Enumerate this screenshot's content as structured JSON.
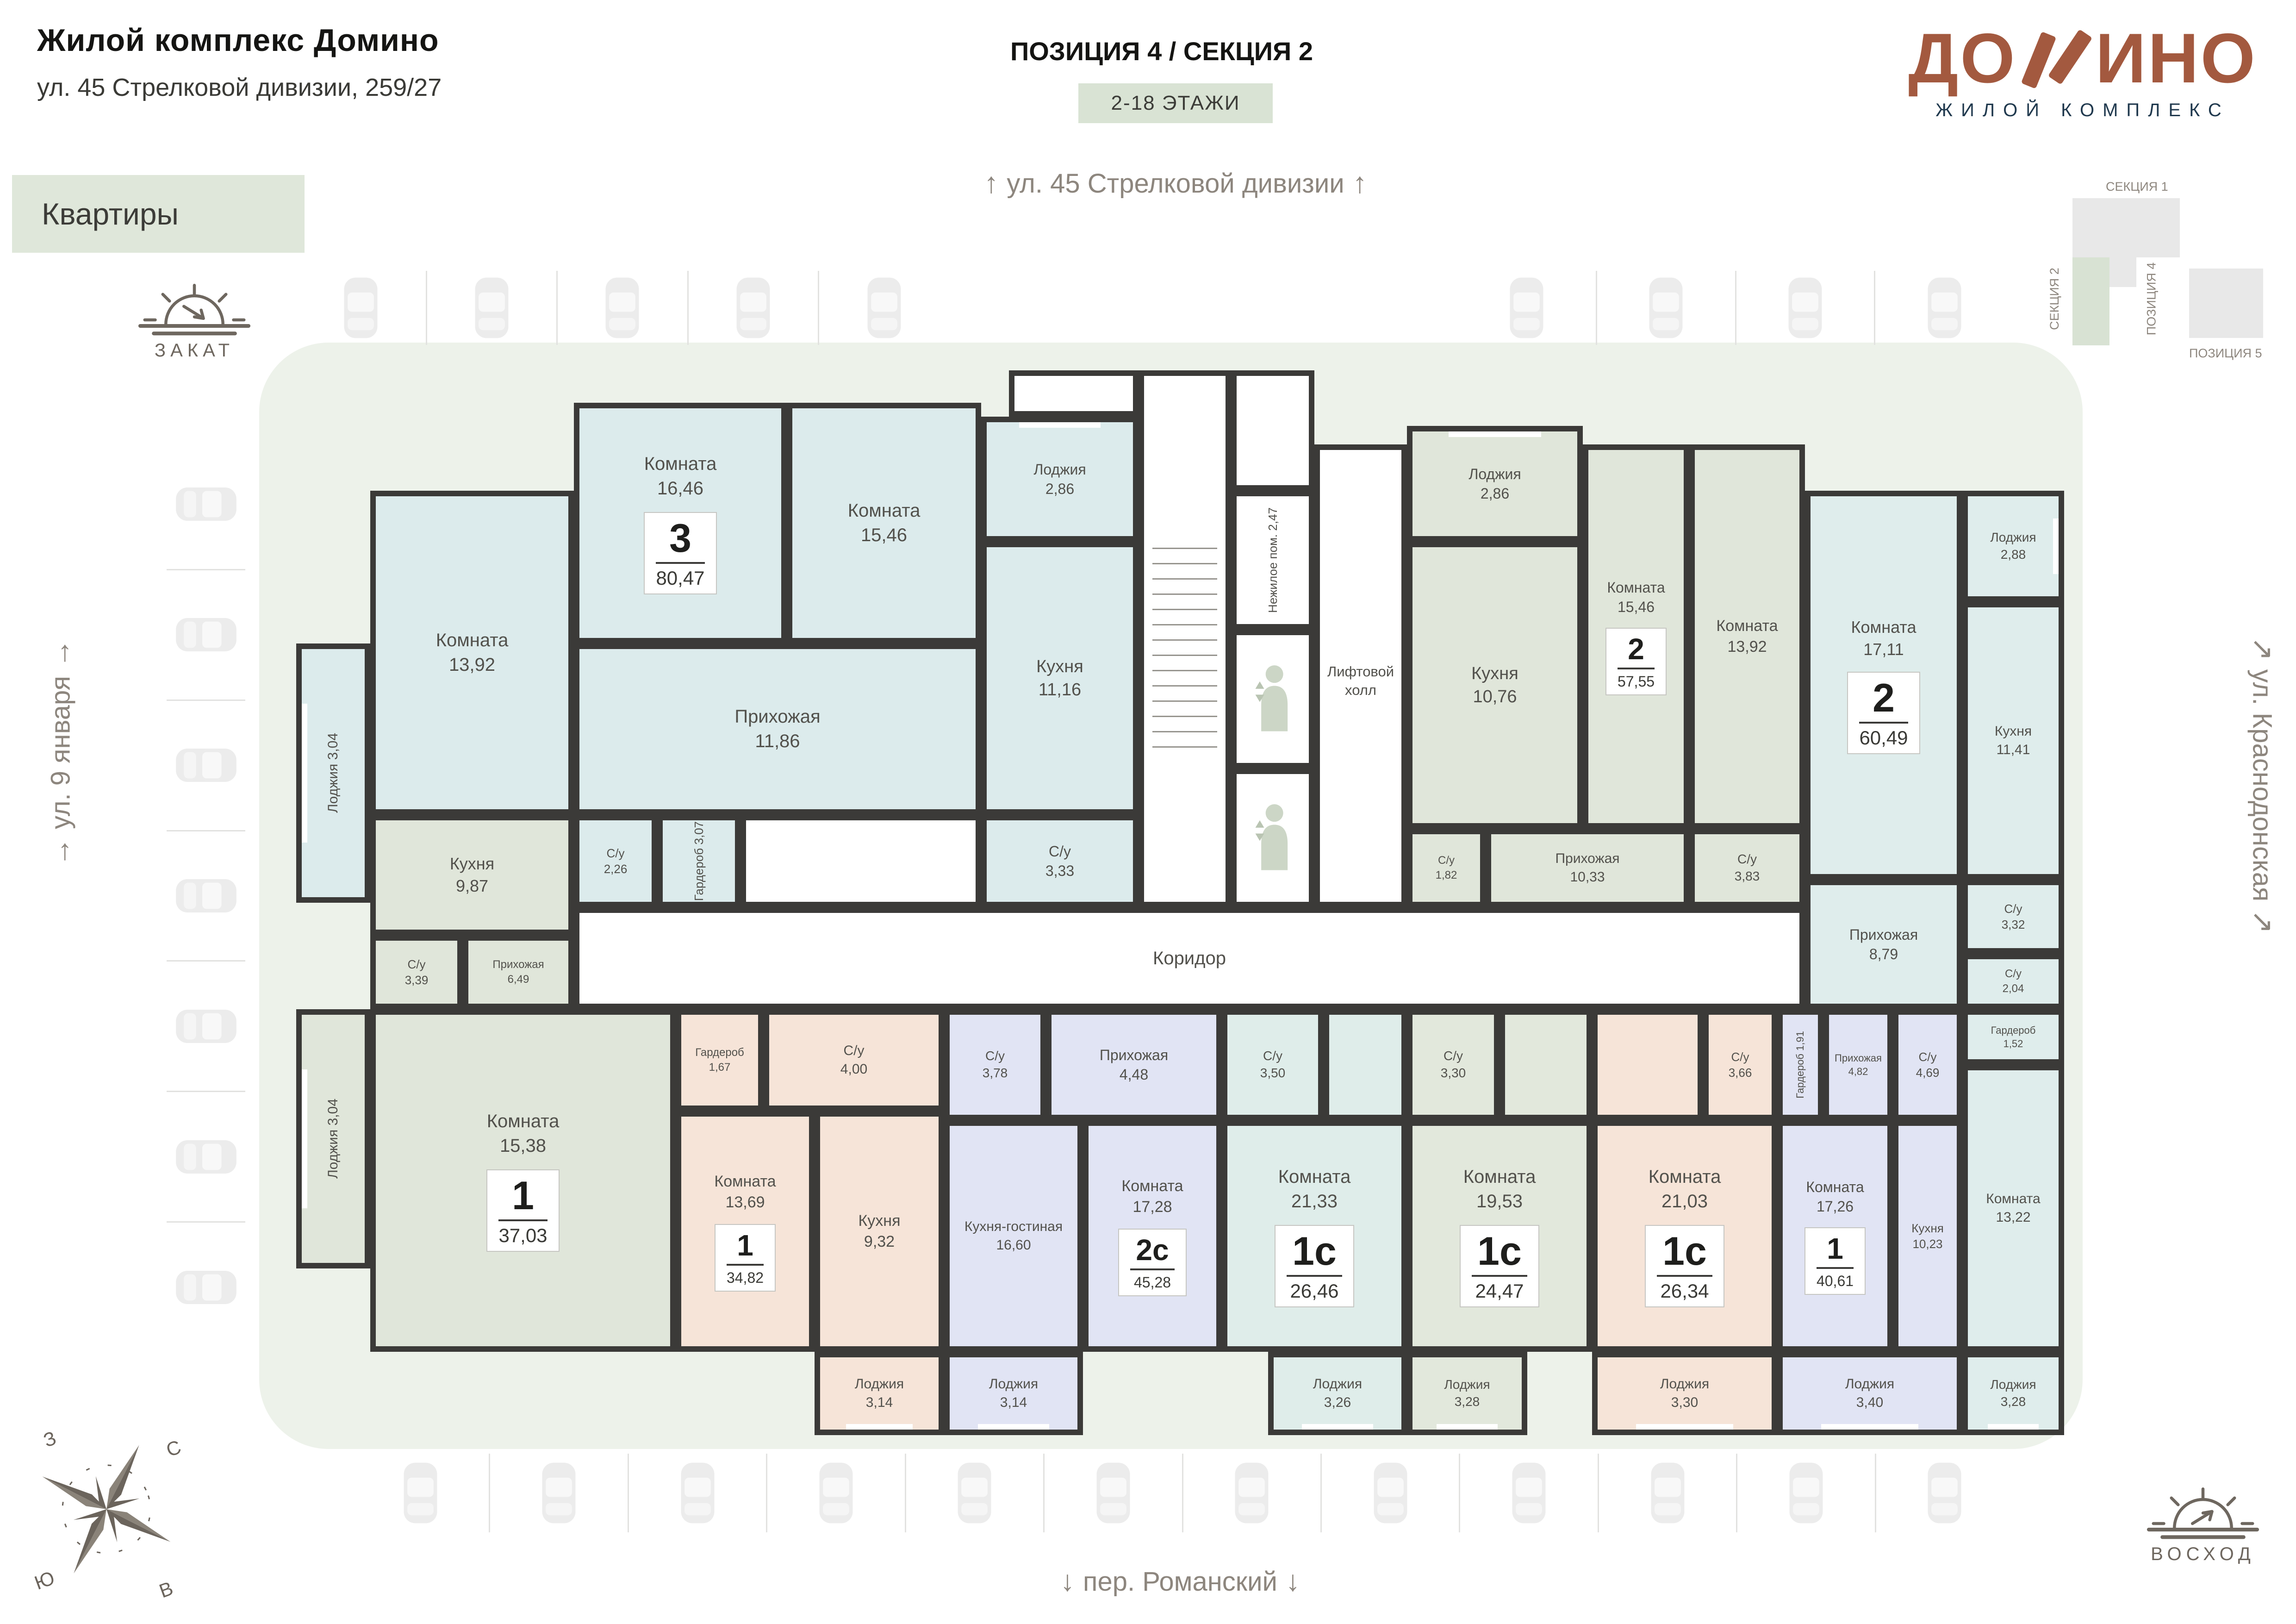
{
  "header": {
    "title": "Жилой комплекс Домино",
    "subtitle": "ул. 45 Стрелковой дивизии, 259/27",
    "tab": "Квартиры",
    "position": "ПОЗИЦИЯ 4 / СЕКЦИЯ 2",
    "floors": "2-18 ЭТАЖИ"
  },
  "logo": {
    "word_start": "ДО",
    "word_end": "ИНО",
    "tagline": "ЖИЛОЙ КОМПЛЕКС",
    "brand_color": "#a3593f"
  },
  "minimap": {
    "section1": "СЕКЦИЯ 1",
    "section2": "СЕКЦИЯ 2",
    "position4": "ПОЗИЦИЯ 4",
    "position5": "ПОЗИЦИЯ 5",
    "highlight_color": "#d8e2d3"
  },
  "streets": {
    "top": "ул. 45 Стрелковой дивизии",
    "bottom": "пер. Романский",
    "left": "ул. 9 января",
    "right": "ул. Краснодонская"
  },
  "sun": {
    "sunset": "ЗАКАТ",
    "sunrise": "ВОСХОД"
  },
  "compass": {
    "n": "С",
    "s": "Ю",
    "w": "З",
    "e": "В"
  },
  "floorplan": {
    "corridor": "Коридор",
    "lift_hall": "Лифтовой холл",
    "nonres": {
      "name": "Нежилое пом.",
      "area": "2,47"
    },
    "wall_color": "#3b3a38",
    "apartments": [
      {
        "type": "3",
        "area": "80,47",
        "color": "#dcebec",
        "badge_room": "a3_room1646",
        "rooms": [
          {
            "id": "a3_room1646",
            "name": "Комната",
            "area": "16,46"
          },
          {
            "id": "a3_room1546",
            "name": "Комната",
            "area": "15,46"
          },
          {
            "id": "a3_room1392",
            "name": "Комната",
            "area": "13,92"
          },
          {
            "id": "a3_kitchen1116",
            "name": "Кухня",
            "area": "11,16"
          },
          {
            "id": "a3_hall1186",
            "name": "Прихожая",
            "area": "11,86"
          },
          {
            "id": "a3_su333",
            "name": "С/у",
            "area": "3,33"
          },
          {
            "id": "a3_su226",
            "name": "С/у",
            "area": "2,26"
          },
          {
            "id": "a3_ward307",
            "name": "Гардероб",
            "area": "3,07"
          },
          {
            "id": "a3_loggia286",
            "name": "Лоджия",
            "area": "2,86"
          },
          {
            "id": "a3_loggia304",
            "name": "Лоджия",
            "area": "3,04"
          }
        ]
      },
      {
        "type": "1",
        "area": "37,03",
        "color": "#e0e6da",
        "badge_room": "a37_room1538",
        "rooms": [
          {
            "id": "a37_kitchen987",
            "name": "Кухня",
            "area": "9,87"
          },
          {
            "id": "a37_su339",
            "name": "С/у",
            "area": "3,39"
          },
          {
            "id": "a37_hall649",
            "name": "Прихожая",
            "area": "6,49"
          },
          {
            "id": "a37_room1538",
            "name": "Комната",
            "area": "15,38"
          },
          {
            "id": "a37_loggia304",
            "name": "Лоджия",
            "area": "3,04"
          }
        ]
      },
      {
        "type": "1",
        "area": "34,82",
        "color": "#f6e4d8",
        "badge_room": "a34_room1369",
        "rooms": [
          {
            "id": "a34_ward167",
            "name": "Гардероб",
            "area": "1,67"
          },
          {
            "id": "a34_su400",
            "name": "С/у",
            "area": "4,00"
          },
          {
            "id": "a34_room1369",
            "name": "Комната",
            "area": "13,69"
          },
          {
            "id": "a34_kitchen932",
            "name": "Кухня",
            "area": "9,32"
          },
          {
            "id": "a34_loggia314",
            "name": "Лоджия",
            "area": "3,14"
          }
        ]
      },
      {
        "type": "2с",
        "area": "45,28",
        "color": "#e1e4f4",
        "badge_room": "a2c_room1728",
        "rooms": [
          {
            "id": "a2c_su378",
            "name": "С/у",
            "area": "3,78"
          },
          {
            "id": "a2c_hall448",
            "name": "Прихожая",
            "area": "4,48"
          },
          {
            "id": "a2c_kg1660",
            "name": "Кухня-гостиная",
            "area": "16,60"
          },
          {
            "id": "a2c_room1728",
            "name": "Комната",
            "area": "17,28"
          },
          {
            "id": "a2c_loggia314",
            "name": "Лоджия",
            "area": "3,14"
          }
        ]
      },
      {
        "type": "1с",
        "area": "26,46",
        "color": "#dfedea",
        "badge_room": "c46_room2133",
        "rooms": [
          {
            "id": "c46_su350",
            "name": "С/у",
            "area": "3,50"
          },
          {
            "id": "c46_room2133",
            "name": "Комната",
            "area": "21,33"
          },
          {
            "id": "c46_loggia326",
            "name": "Лоджия",
            "area": "3,26"
          }
        ]
      },
      {
        "type": "1с",
        "area": "24,47",
        "color": "#e2e8dc",
        "badge_room": "c44_room1953",
        "rooms": [
          {
            "id": "c44_su330",
            "name": "С/у",
            "area": "3,30"
          },
          {
            "id": "c44_room1953",
            "name": "Комната",
            "area": "19,53"
          },
          {
            "id": "c44_loggia328",
            "name": "Лоджия",
            "area": "3,28"
          }
        ]
      },
      {
        "type": "1с",
        "area": "26,34",
        "color": "#f6e4d8",
        "badge_room": "c26_room2103",
        "rooms": [
          {
            "id": "c26_su366",
            "name": "С/у",
            "area": "3,66"
          },
          {
            "id": "c26_room2103",
            "name": "Комната",
            "area": "21,03"
          },
          {
            "id": "c26_loggia330",
            "name": "Лоджия",
            "area": "3,30"
          }
        ]
      },
      {
        "type": "1",
        "area": "40,61",
        "color": "#e1e4f4",
        "badge_room": "a40_room1726",
        "rooms": [
          {
            "id": "a40_ward191",
            "name": "Гардероб",
            "area": "1,91"
          },
          {
            "id": "a40_hall482",
            "name": "Прихожая",
            "area": "4,82"
          },
          {
            "id": "a40_su469",
            "name": "С/у",
            "area": "4,69"
          },
          {
            "id": "a40_room1726",
            "name": "Комната",
            "area": "17,26"
          },
          {
            "id": "a40_kitchen1023",
            "name": "Кухня",
            "area": "10,23"
          },
          {
            "id": "a40_loggia340",
            "name": "Лоджия",
            "area": "3,40"
          }
        ]
      },
      {
        "type": "2",
        "area": "57,55",
        "color": "#e0e6da",
        "badge_room": "a57_room1546",
        "rooms": [
          {
            "id": "a57_loggia286",
            "name": "Лоджия",
            "area": "2,86"
          },
          {
            "id": "a57_kitchen1076",
            "name": "Кухня",
            "area": "10,76"
          },
          {
            "id": "a57_room1546",
            "name": "Комната",
            "area": "15,46"
          },
          {
            "id": "a57_room1392",
            "name": "Комната",
            "area": "13,92"
          },
          {
            "id": "a57_su182",
            "name": "С/у",
            "area": "1,82"
          },
          {
            "id": "a57_hall1033",
            "name": "Прихожая",
            "area": "10,33"
          },
          {
            "id": "a57_su383",
            "name": "С/у",
            "area": "3,83"
          }
        ]
      },
      {
        "type": "2",
        "area": "60,49",
        "color": "#dfedec",
        "badge_room": "a60_room1711",
        "rooms": [
          {
            "id": "a60_room1711",
            "name": "Комната",
            "area": "17,11"
          },
          {
            "id": "a60_kitchen1141",
            "name": "Кухня",
            "area": "11,41"
          },
          {
            "id": "a60_loggia288",
            "name": "Лоджия",
            "area": "2,88"
          },
          {
            "id": "a60_hall879",
            "name": "Прихожая",
            "area": "8,79"
          },
          {
            "id": "a60_su332",
            "name": "С/у",
            "area": "3,32"
          },
          {
            "id": "a60_su204",
            "name": "С/у",
            "area": "2,04"
          },
          {
            "id": "a60_ward152",
            "name": "Гардероб",
            "area": "1,52"
          },
          {
            "id": "a60_room1322",
            "name": "Комната",
            "area": "13,22"
          },
          {
            "id": "a60_loggia328",
            "name": "Лоджия",
            "area": "3,28"
          }
        ]
      }
    ]
  }
}
